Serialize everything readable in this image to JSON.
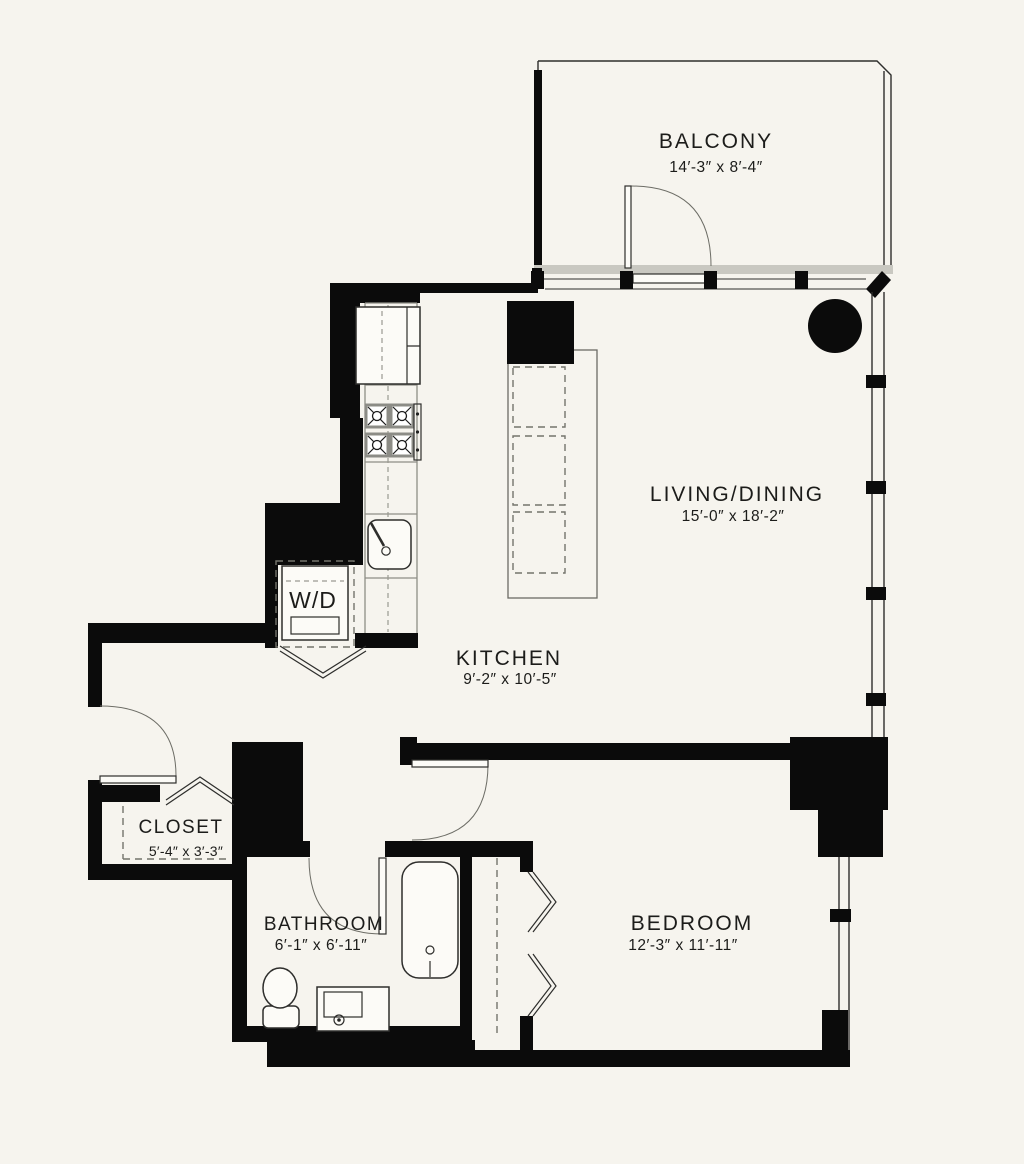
{
  "palette": {
    "background": "#f6f4ee",
    "wall": "#0b0b0b",
    "line": "#2e2e2c",
    "window_band": "#c9c8c1",
    "counter_gray": "#8e8e86",
    "dash_gray": "#74746c",
    "fixture_fill": "#fcfbf7",
    "ink": "#1c1c1a"
  },
  "rooms": {
    "balcony": {
      "name": "BALCONY",
      "dims": "14′-3″ x 8′-4″"
    },
    "living_dining": {
      "name": "LIVING/DINING",
      "dims": "15′-0″ x 18′-2″"
    },
    "kitchen": {
      "name": "KITCHEN",
      "dims": "9′-2″ x 10′-5″"
    },
    "closet": {
      "name": "CLOSET",
      "dims": "5′-4″ x 3′-3″"
    },
    "bathroom": {
      "name": "BATHROOM",
      "dims": "6′-1″ x 6′-11″"
    },
    "bedroom": {
      "name": "BEDROOM",
      "dims": "12′-3″ x 11′-11″"
    },
    "laundry": {
      "name": "W/D"
    }
  }
}
